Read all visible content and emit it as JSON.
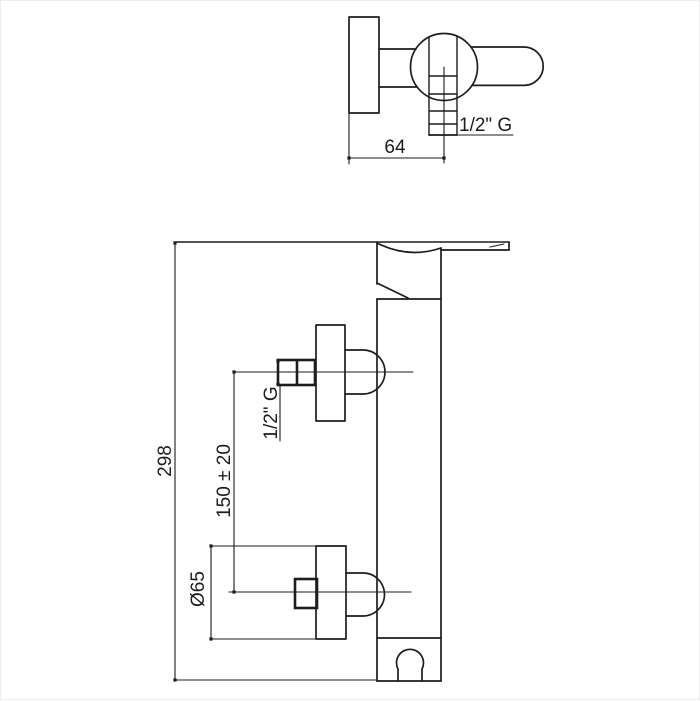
{
  "drawing": {
    "line_color": "#1d1d1d",
    "background": "#ffffff",
    "labels": {
      "top_width": "64",
      "top_thread": "1/2\" G",
      "overall_height": "298",
      "outlet_spacing": "150 ± 20",
      "side_thread": "1/2\" G",
      "flange_diameter": "Ø65"
    }
  }
}
